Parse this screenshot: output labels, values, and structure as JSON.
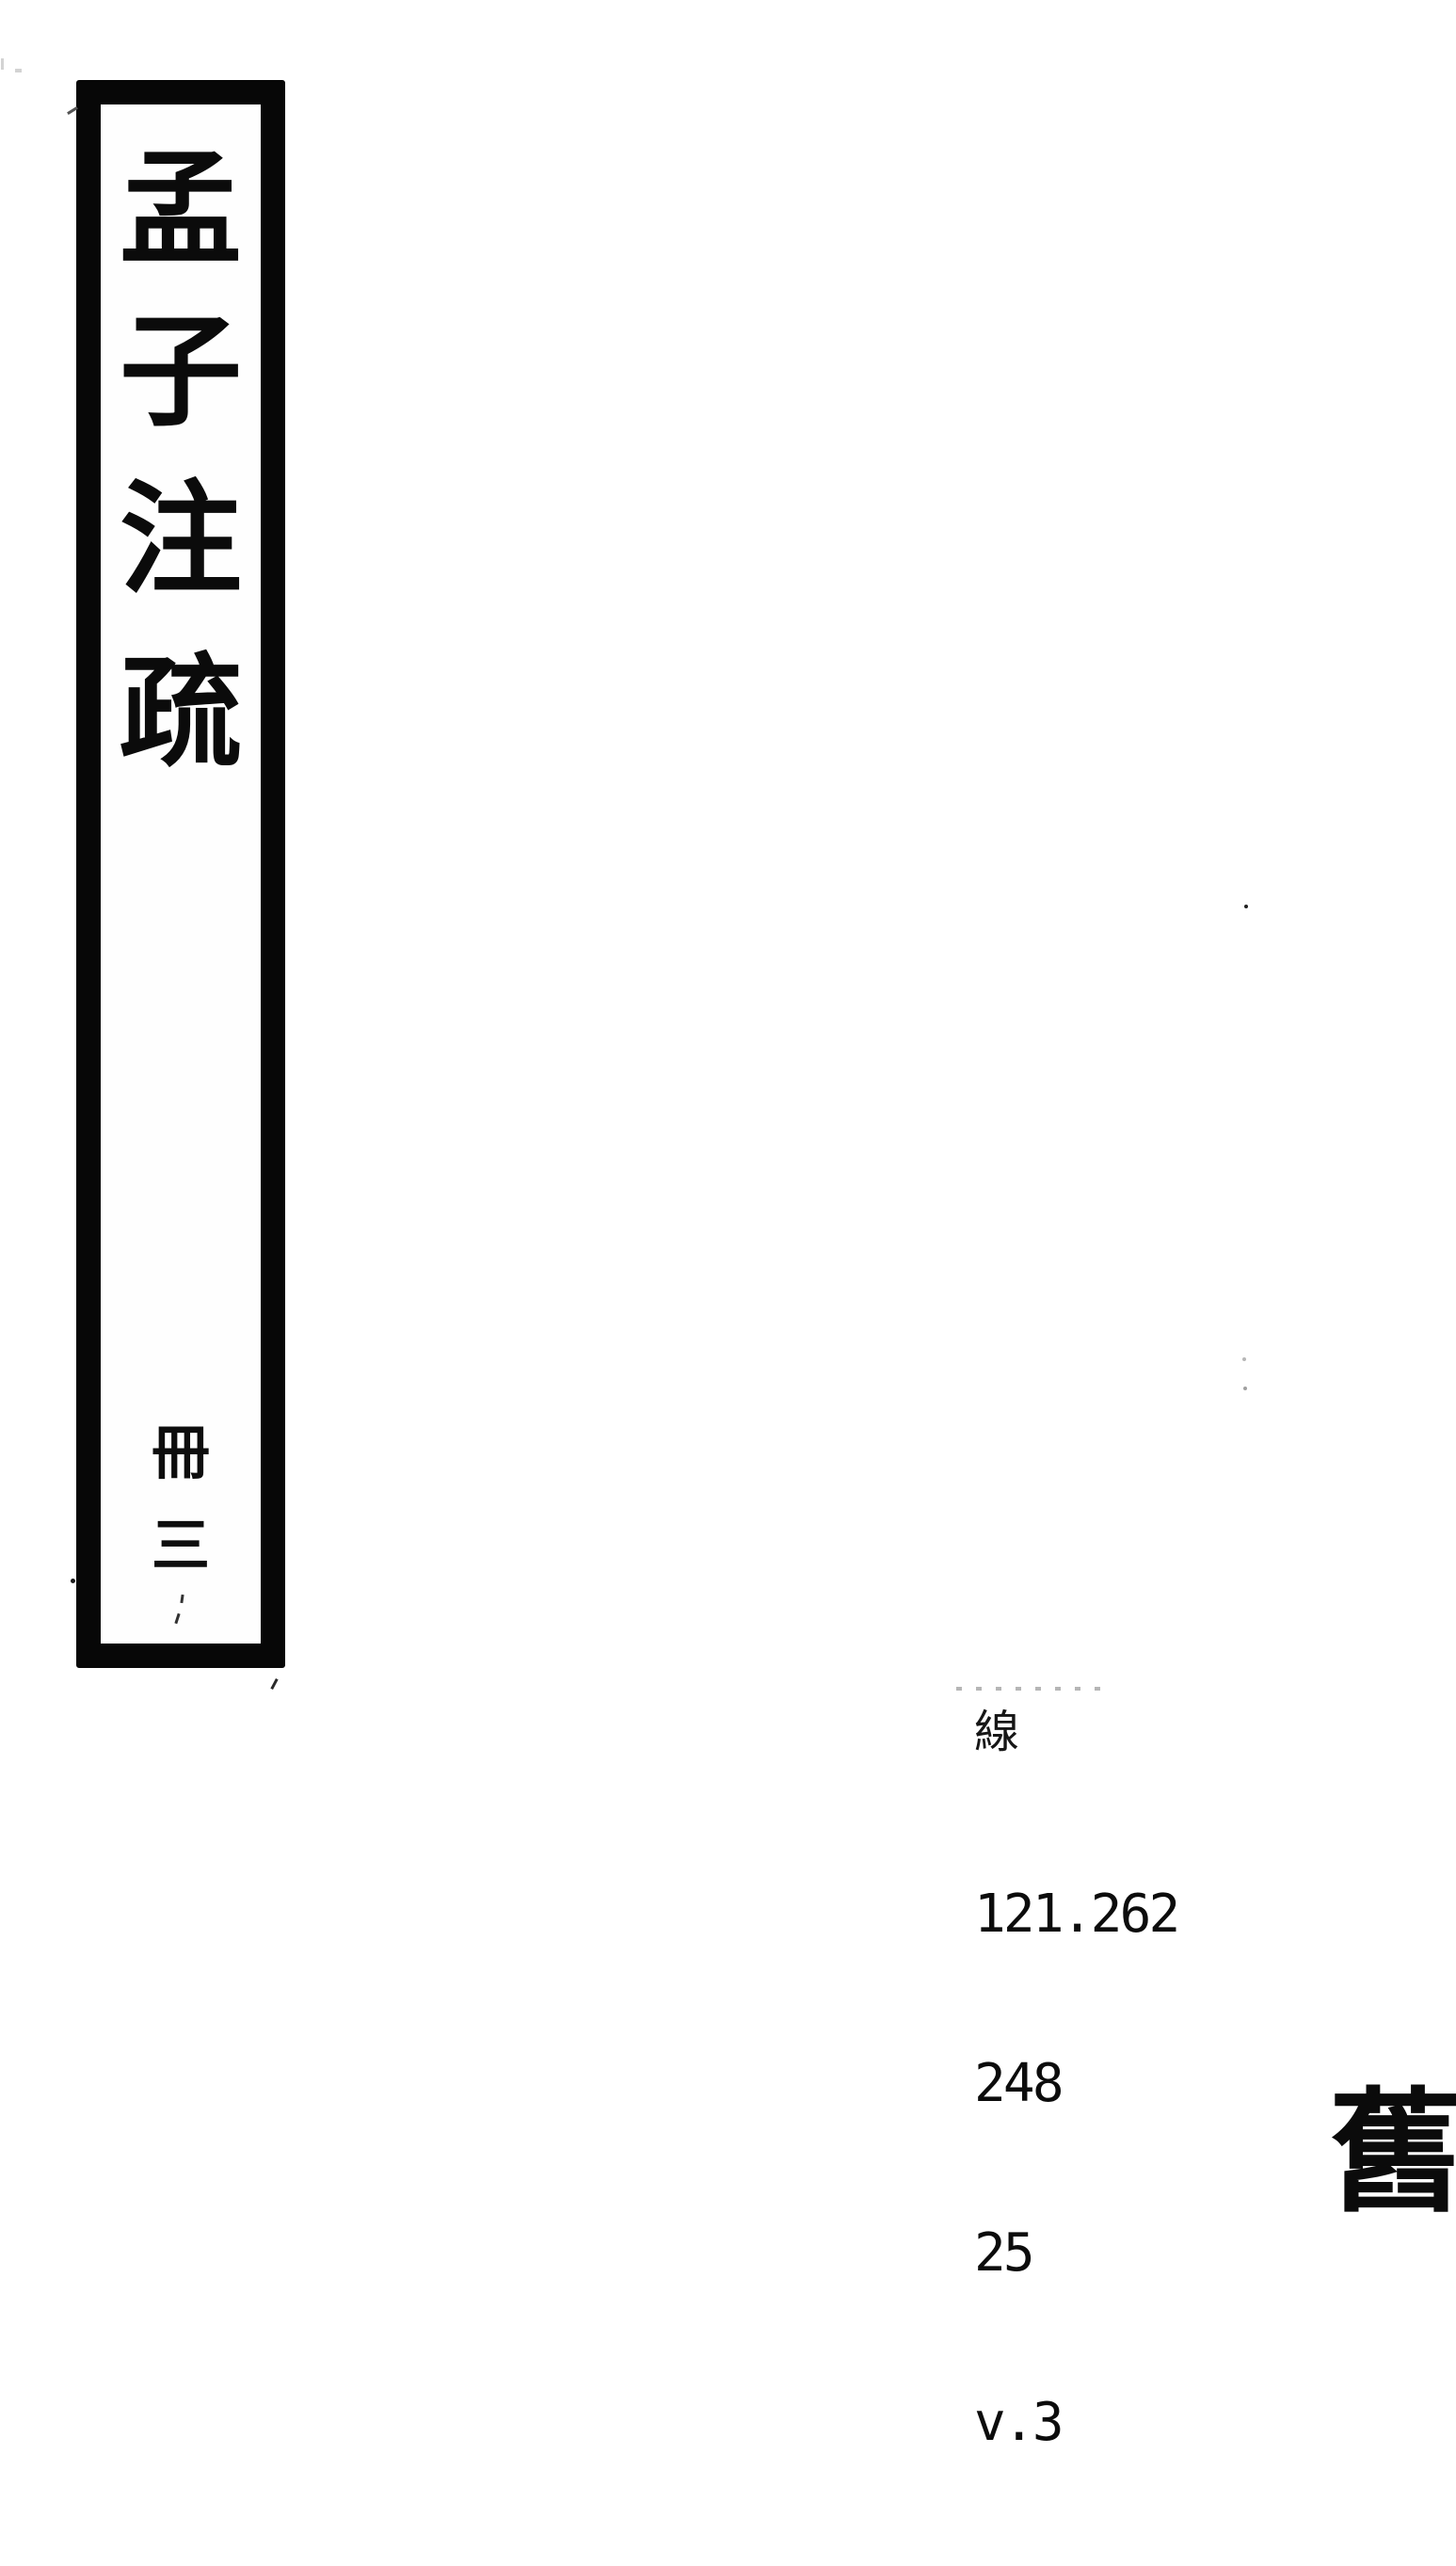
{
  "spine_label": {
    "title": "孟子注疏",
    "title_chars": [
      "孟",
      "子",
      "注",
      "疏"
    ],
    "volume": "冊三",
    "volume_chars": [
      "冊",
      "三"
    ]
  },
  "call_number": {
    "prefix_char": "線",
    "lines": [
      "121.262",
      "248",
      "25",
      "v.3"
    ]
  },
  "stamp": {
    "char": "舊"
  },
  "colors": {
    "ink": "#0b0b0b",
    "paper": "#ffffff",
    "faint_mark": "#9e9e9e"
  }
}
